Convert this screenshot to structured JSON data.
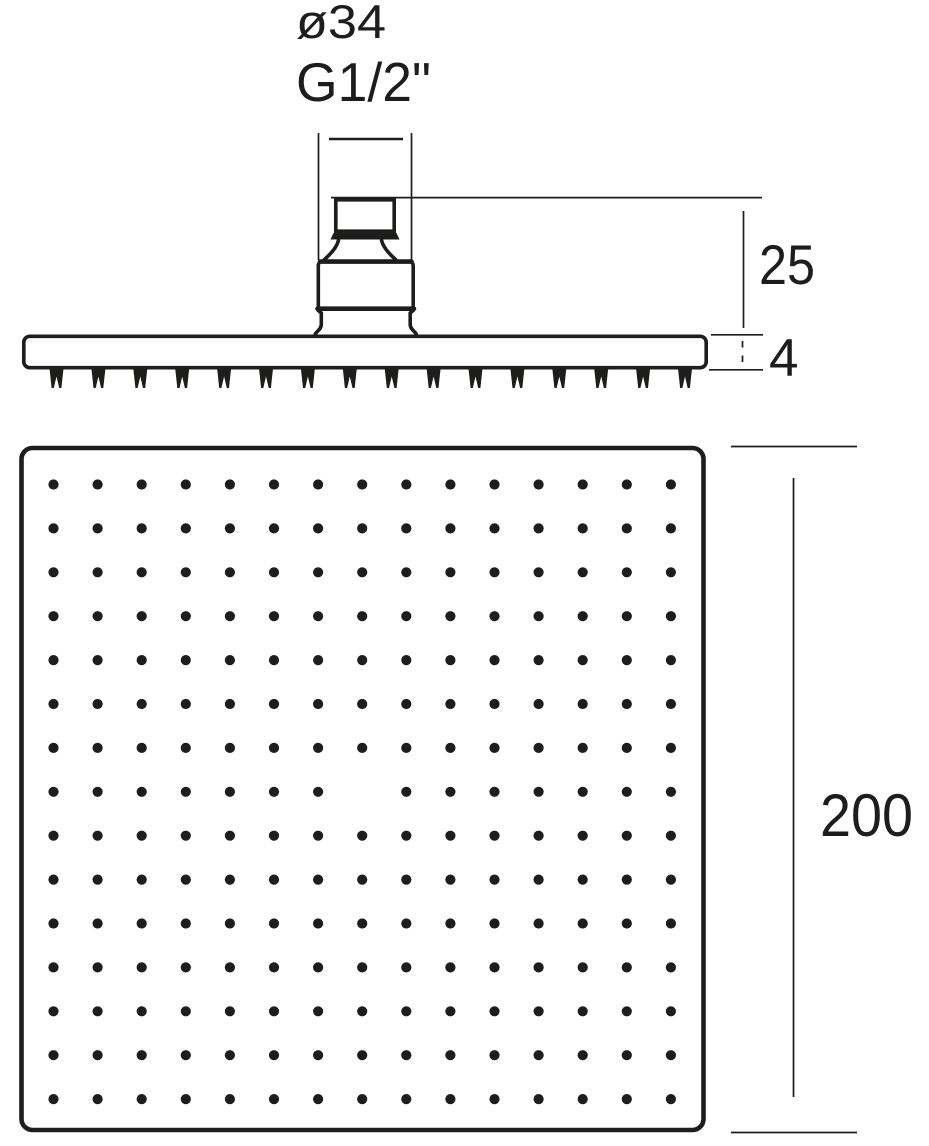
{
  "drawing": {
    "kind": "technical dimension drawing",
    "subject": "square overhead rain shower head — side elevation (top) and spray-face plan view (bottom)",
    "colors": {
      "ink": "#1d1d1b",
      "background": "#ffffff"
    },
    "labels": {
      "diameter": "ø34",
      "thread": "G1/2\"",
      "connector_height": "25",
      "plate_thickness": "4",
      "plate_width": "200"
    },
    "side_view": {
      "nozzle_count": 16
    },
    "plan_view": {
      "grid_rows": 15,
      "grid_cols": 15,
      "center_hole_missing": true,
      "visible_hole_count": 224
    }
  }
}
